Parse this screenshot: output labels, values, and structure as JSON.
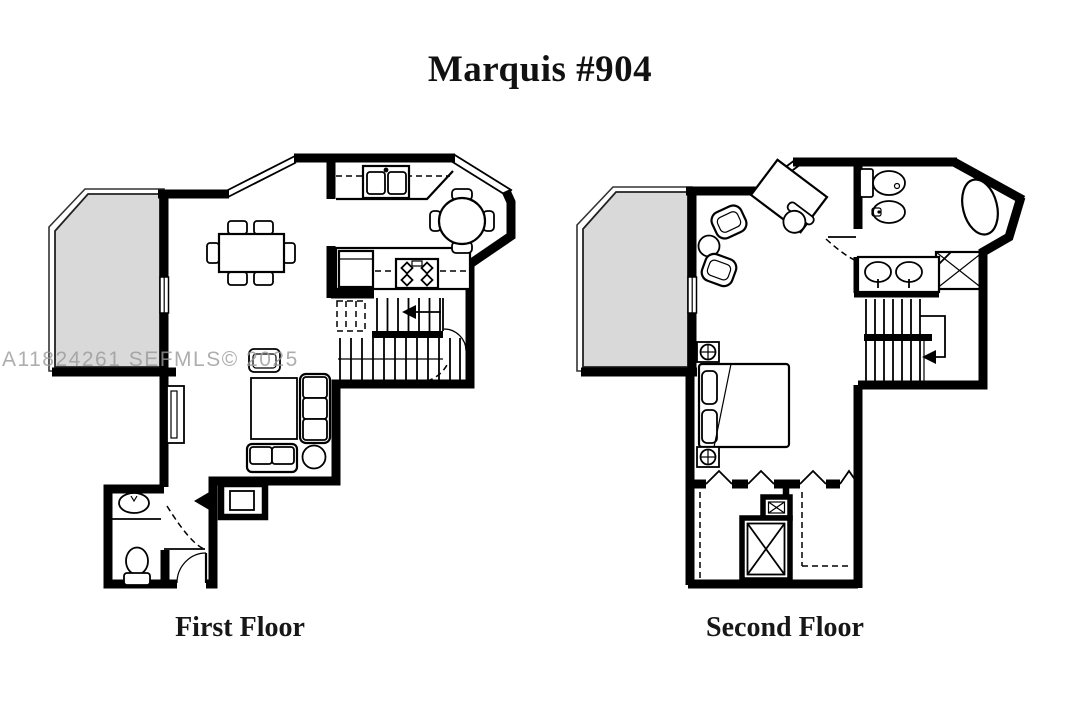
{
  "title": "Marquis #904",
  "watermark": "A11824261 SEFMLS© 2025",
  "floors": [
    {
      "id": "first-floor",
      "label": "First Floor",
      "features": [
        "balcony",
        "sliding-glass-door",
        "dining-table-six-chairs",
        "kitchen-double-sink",
        "upper-cabinets",
        "refrigerator",
        "range-stove",
        "breakfast-table-four-seats",
        "staircase-up",
        "under-stair-pantry",
        "wall-mounted-tv",
        "armchair",
        "area-rug",
        "sofa",
        "loveseat",
        "round-side-table",
        "entry-closet",
        "entry-door",
        "powder-room-sink",
        "toilet"
      ]
    },
    {
      "id": "second-floor",
      "label": "Second Floor",
      "features": [
        "balcony",
        "sliding-glass-door",
        "desk",
        "desk-chair",
        "armchairs",
        "round-side-table",
        "toilet",
        "bidet",
        "bathtub",
        "shower",
        "double-vanity",
        "staircase-down",
        "bed",
        "nightstand-lamps",
        "closets-with-folding-doors",
        "mechanical-closet"
      ]
    }
  ],
  "colors": {
    "background": "#ffffff",
    "walls": "#000000",
    "balcony_fill": "#d9d9d9",
    "watermark": "#9a9a9a",
    "text": "#111111"
  }
}
